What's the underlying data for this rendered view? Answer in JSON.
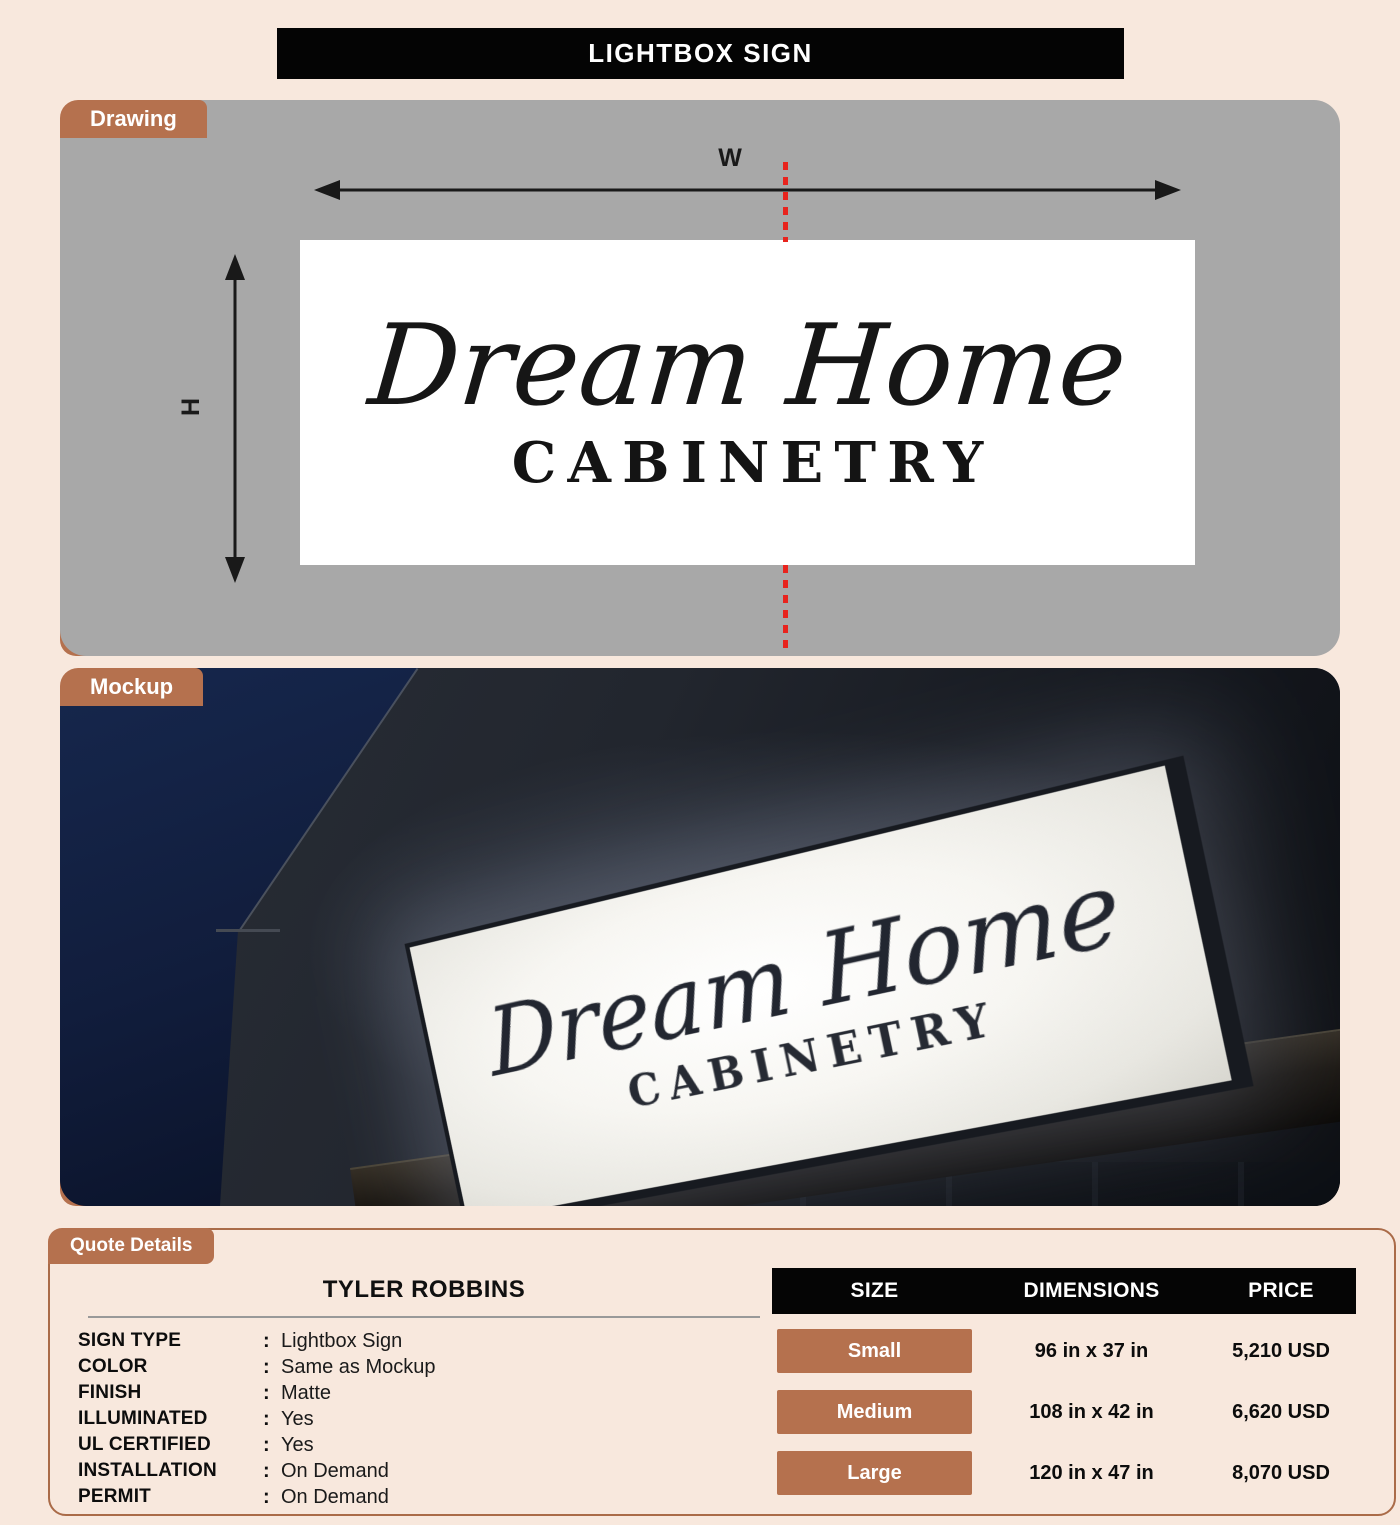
{
  "title_bar": {
    "text": "LIGHTBOX SIGN"
  },
  "drawing": {
    "tab_label": "Drawing",
    "width_label": "W",
    "height_label": "H",
    "sign_line1": "Dream Home",
    "sign_line2": "CABINETRY"
  },
  "mockup": {
    "tab_label": "Mockup",
    "sign_line1": "Dream Home",
    "sign_line2": "CABINETRY"
  },
  "quote": {
    "tab_label": "Quote Details",
    "customer_name": "TYLER ROBBINS",
    "separator": ":",
    "fields": [
      {
        "label": "SIGN TYPE",
        "value": "Lightbox Sign"
      },
      {
        "label": "COLOR",
        "value": "Same as Mockup"
      },
      {
        "label": "FINISH",
        "value": "Matte"
      },
      {
        "label": "ILLUMINATED",
        "value": "Yes"
      },
      {
        "label": "UL CERTIFIED",
        "value": "Yes"
      },
      {
        "label": "INSTALLATION",
        "value": "On Demand"
      },
      {
        "label": "PERMIT",
        "value": "On Demand"
      }
    ],
    "table": {
      "headers": [
        "SIZE",
        "DIMENSIONS",
        "PRICE"
      ],
      "rows": [
        {
          "size": "Small",
          "dimensions": "96 in x 37 in",
          "price": "5,210 USD"
        },
        {
          "size": "Medium",
          "dimensions": "108 in x 42 in",
          "price": "6,620 USD"
        },
        {
          "size": "Large",
          "dimensions": "120 in x 47 in",
          "price": "8,070 USD"
        }
      ]
    }
  },
  "colors": {
    "accent_copper": "#b5714e",
    "page_background": "#f8e8dd",
    "drawing_background": "#a8a8a8",
    "header_black": "#040404",
    "dimension_red": "#e8231d"
  }
}
